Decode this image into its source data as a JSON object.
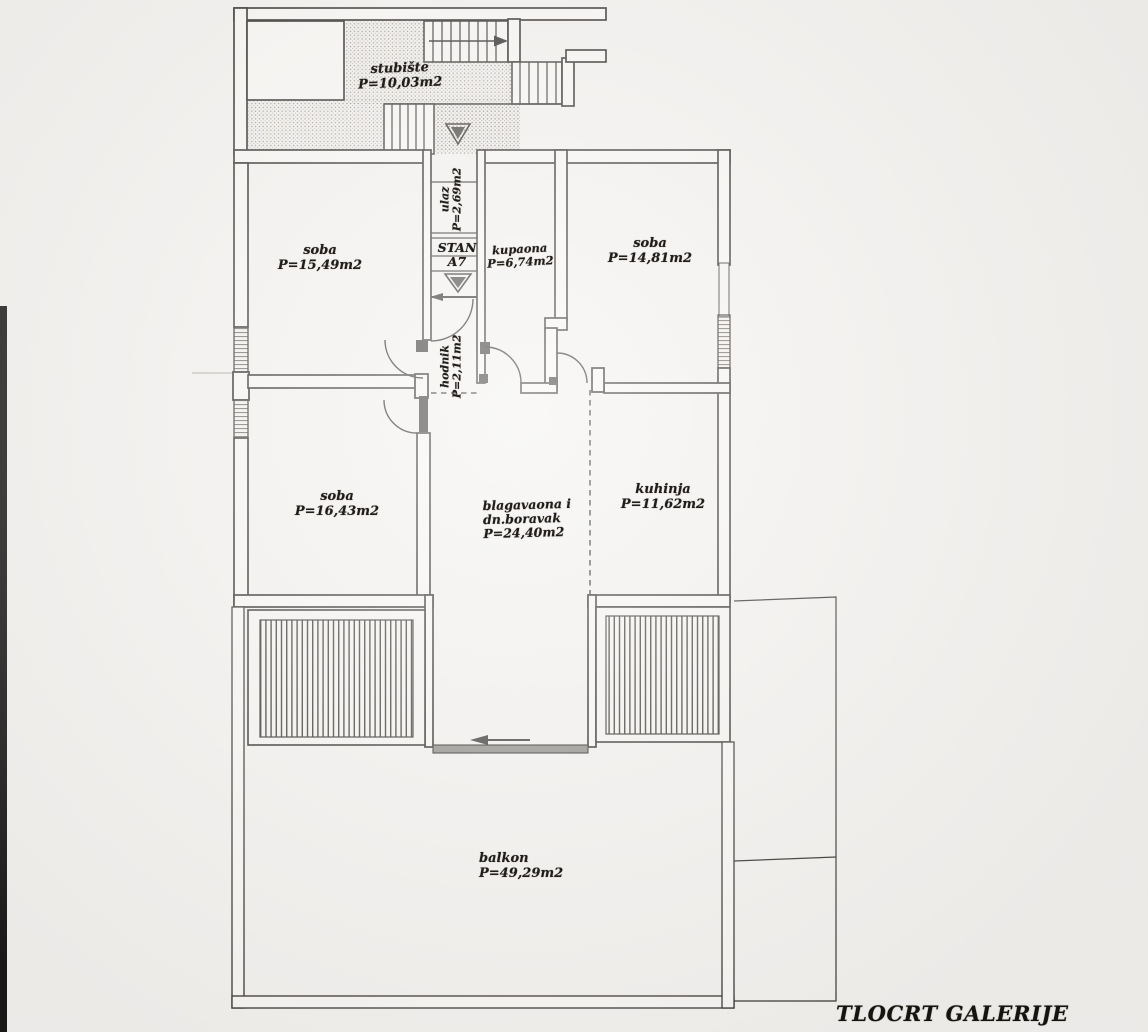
{
  "title": "TLOCRT GALERIJE",
  "unit": {
    "line1": "STAN",
    "line2": "A7"
  },
  "rooms": {
    "stubiste": {
      "name": "stubište",
      "area": "P=10,03m2"
    },
    "ulaz": {
      "name": "ulaz",
      "area": "P=2,69m2"
    },
    "soba_gornja": {
      "name": "soba",
      "area": "P=15,49m2"
    },
    "kupaona": {
      "name": "kupaona",
      "area": "P=6,74m2"
    },
    "soba_desna": {
      "name": "soba",
      "area": "P=14,81m2"
    },
    "hodnik": {
      "name": "hodnik",
      "area": "P=2,11m2"
    },
    "soba_lijeva": {
      "name": "soba",
      "area": "P=16,43m2"
    },
    "blagavaona": {
      "name_line1": "blagavaona i",
      "name_line2": "dn.boravak",
      "area": "P=24,40m2"
    },
    "kuhinja": {
      "name": "kuhinja",
      "area": "P=11,62m2"
    },
    "balkon": {
      "name": "balkon",
      "area": "P=49,29m2"
    }
  },
  "colors": {
    "ink": "#2f2c29",
    "paper": "#f3f1ee",
    "scan_edge": "#191919",
    "slider": "#8f8c88"
  }
}
